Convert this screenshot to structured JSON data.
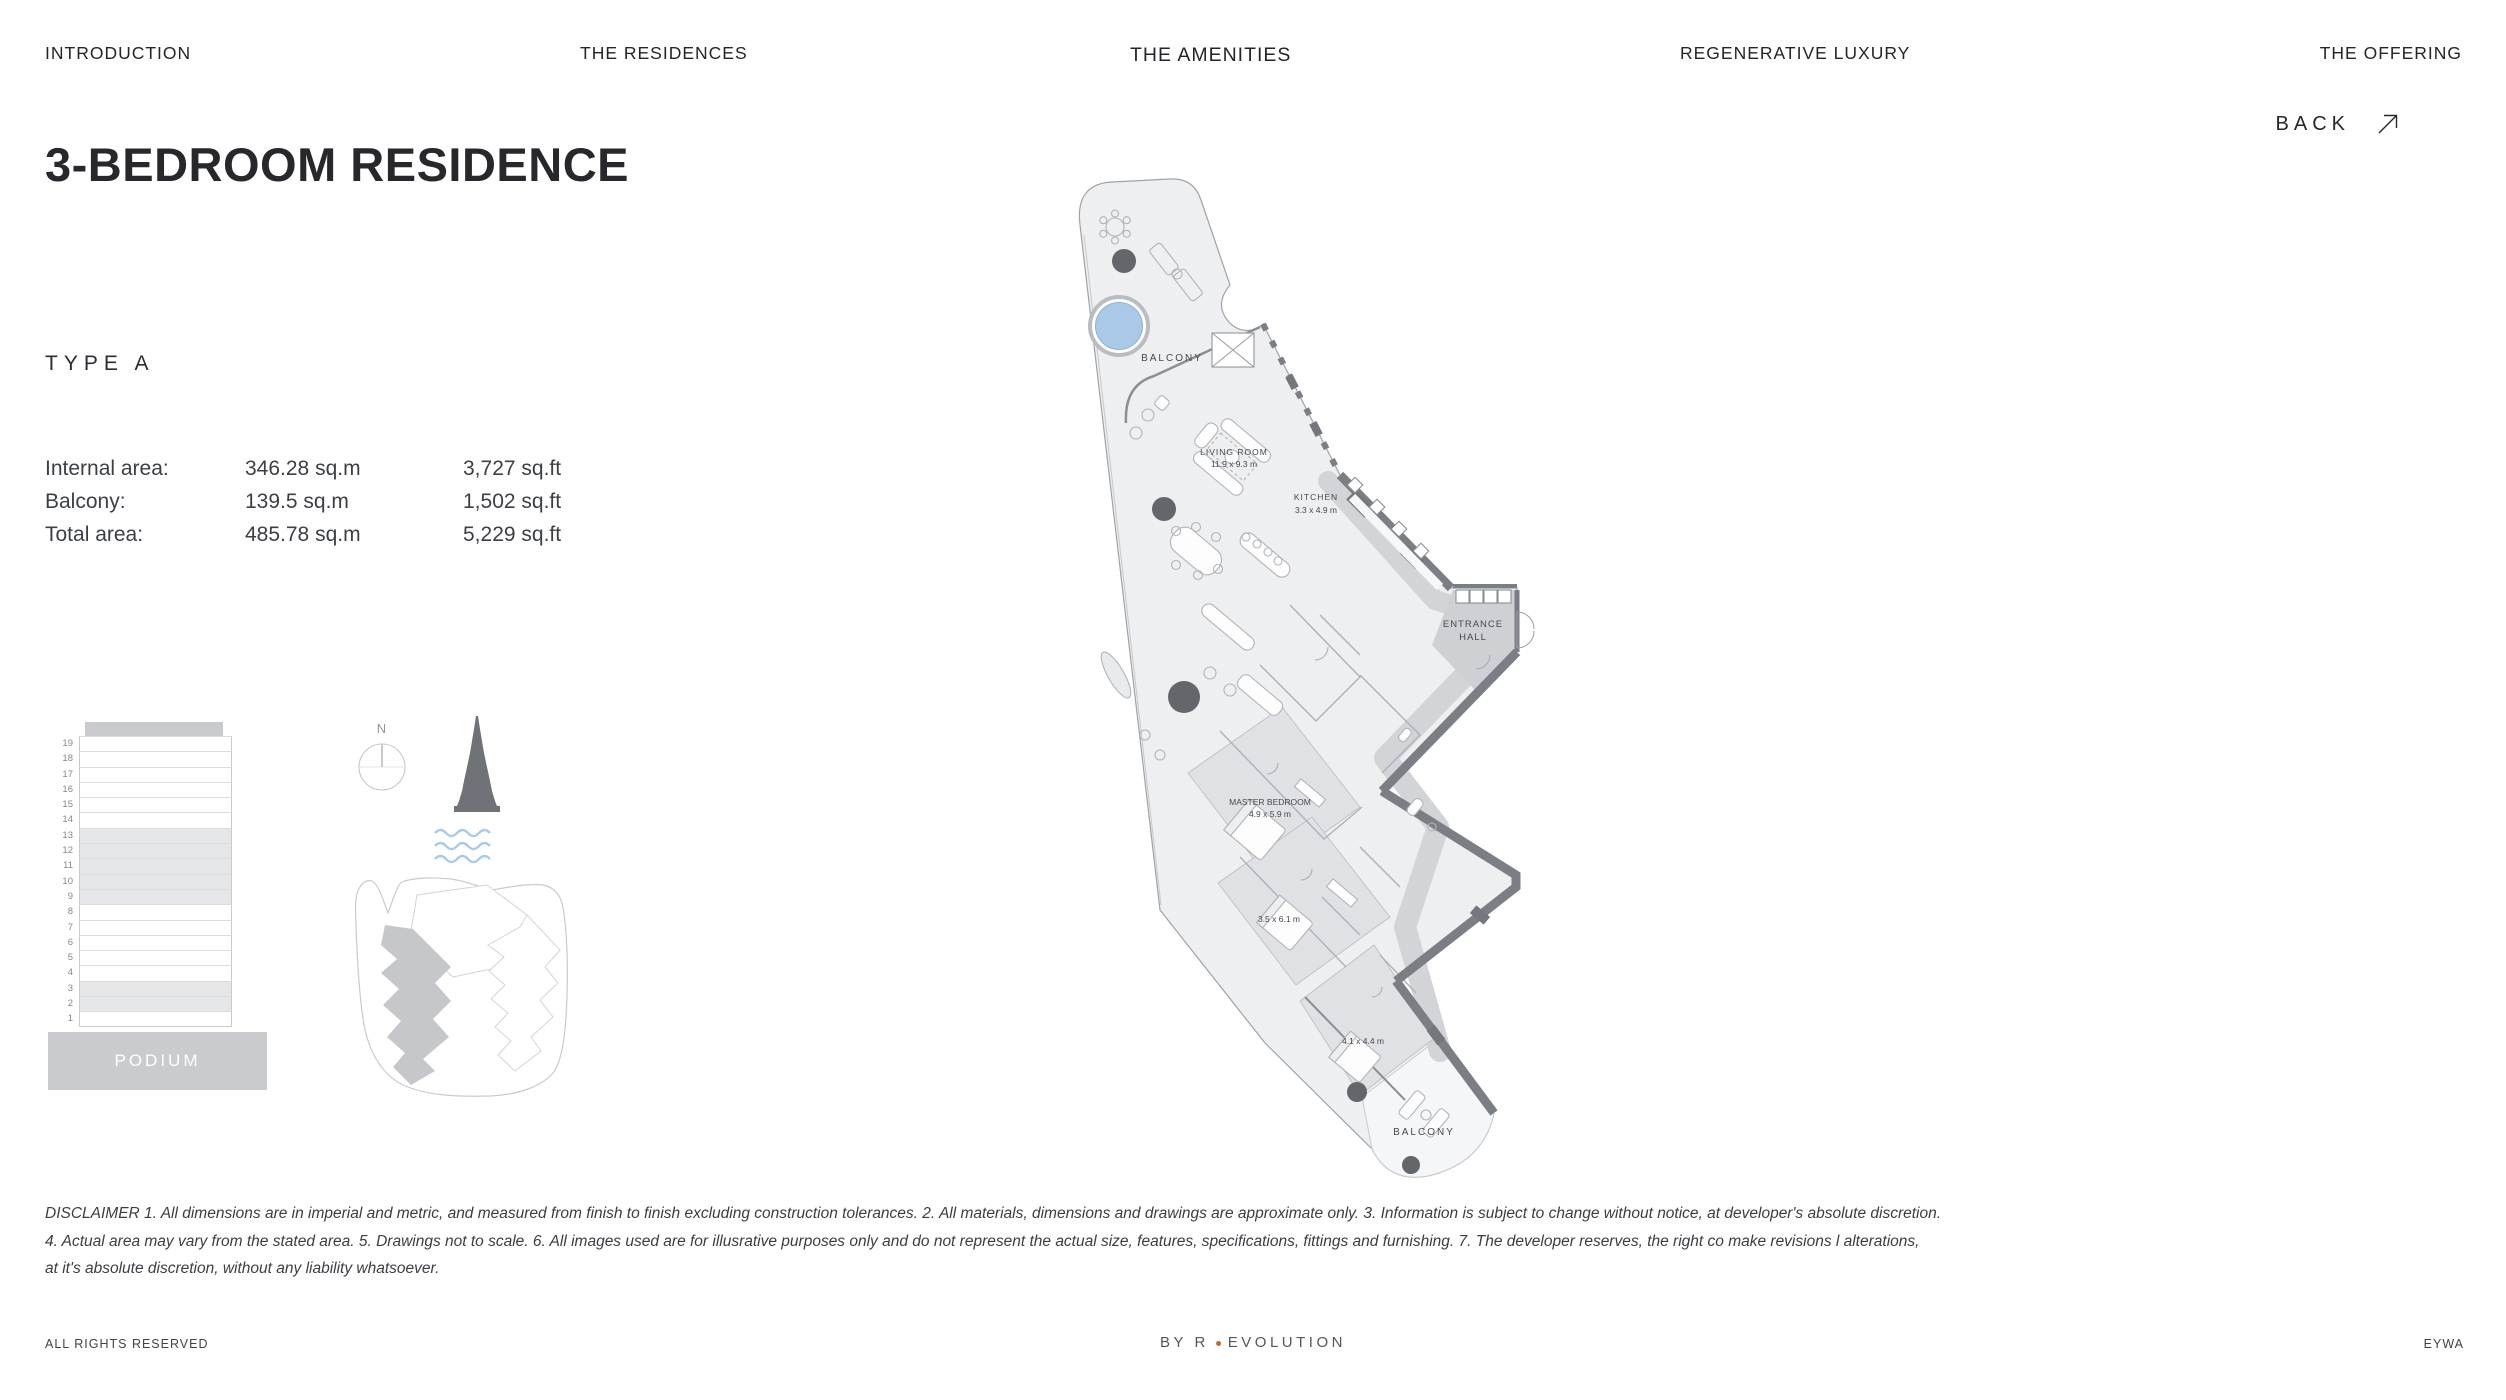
{
  "nav": {
    "items": [
      {
        "label": "INTRODUCTION",
        "active": false
      },
      {
        "label": "THE RESIDENCES",
        "active": false
      },
      {
        "label": "THE AMENITIES",
        "active": true
      },
      {
        "label": "REGENERATIVE LUXURY",
        "active": false
      },
      {
        "label": "THE OFFERING",
        "active": false
      }
    ]
  },
  "header": {
    "title": "3-BEDROOM RESIDENCE",
    "back_label": "BACK"
  },
  "unit": {
    "type_label": "TYPE A",
    "area_rows": [
      {
        "label": "Internal area:",
        "metric": "346.28 sq.m",
        "imperial": "3,727 sq.ft"
      },
      {
        "label": "Balcony:",
        "metric": "139.5 sq.m",
        "imperial": "1,502 sq.ft"
      },
      {
        "label": "Total area:",
        "metric": "485.78 sq.m",
        "imperial": "5,229 sq.ft"
      }
    ]
  },
  "locator": {
    "floors": [
      "19",
      "18",
      "17",
      "16",
      "15",
      "14",
      "13",
      "12",
      "11",
      "10",
      "9",
      "8",
      "7",
      "6",
      "5",
      "4",
      "3",
      "2",
      "1"
    ],
    "highlighted_floors": [
      "13",
      "12",
      "11",
      "10",
      "9",
      "3",
      "2"
    ],
    "podium_label": "PODIUM",
    "compass_label": "N"
  },
  "floorplan": {
    "balcony_top_label": "BALCONY",
    "living_room_name": "LIVING ROOM",
    "living_room_dim": "11.9 x 9.3 m",
    "kitchen_name": "KITCHEN",
    "kitchen_dim": "3.3 x 4.9 m",
    "entrance_line1": "ENTRANCE",
    "entrance_line2": "HALL",
    "master_name": "MASTER BEDROOM",
    "master_dim": "4.9 x 5.9 m",
    "bedroom2_dim": "3.5 x 6.1 m",
    "bedroom3_dim": "4.1 x 4.4 m",
    "balcony_bottom_label": "BALCONY",
    "pool_color": "#a9c9e6",
    "wall_color": "#7b7e84"
  },
  "disclaimer": {
    "lines": [
      "DISCLAIMER 1. All dimensions are in imperial and metric, and measured from finish to finish excluding construction tolerances. 2. All materials, dimensions and drawings are approximate only. 3. Information is subject to change without notice, at developer's absolute discretion.",
      "4. Actual area may vary from the stated area. 5. Drawings not to scale. 6. All images used are for illusrative purposes only and do not represent the actual size, features, specifications, fittings and furnishing. 7. The developer reserves, the right co make revisions l alterations,",
      "at it's absolute discretion, without any liability whatsoever."
    ]
  },
  "footer": {
    "left": "ALL RIGHTS RESERVED",
    "center_prefix": "BY R",
    "center_suffix": "EVOLUTION",
    "right": "EYWA",
    "dot_color": "#bf6b2e"
  }
}
